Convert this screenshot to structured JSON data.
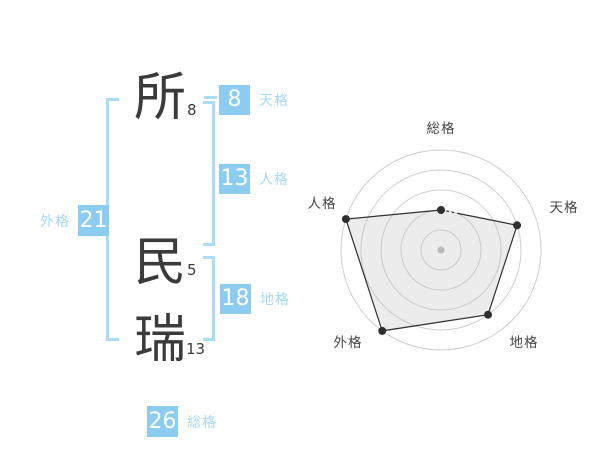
{
  "name_panel": {
    "characters": [
      {
        "char": "所",
        "strokes": "8"
      },
      {
        "char": "民",
        "strokes": "5"
      },
      {
        "char": "瑞",
        "strokes": "13"
      }
    ],
    "badges": {
      "tenkaku": {
        "value": "8",
        "label": "天格"
      },
      "jinkaku": {
        "value": "13",
        "label": "人格"
      },
      "chikaku": {
        "value": "18",
        "label": "地格"
      },
      "gaikaku": {
        "value": "21",
        "label": "外格"
      },
      "soukaku": {
        "value": "26",
        "label": "総格"
      }
    }
  },
  "colors": {
    "badge_blue": "#8cccf0",
    "light_blue_label": "#a5d9f6",
    "bracket_blue": "#a9dcf7",
    "ink": "#3b3b3b",
    "ring_gray": "#cfcfcf",
    "polygon_stroke": "#2f2f2f",
    "polygon_fill": "rgba(185,185,185,0.28)",
    "center_dot": "#b9b9b9",
    "axis_label": "#474747"
  },
  "chart_data": {
    "type": "radar",
    "title": "",
    "axes": [
      "総格",
      "天格",
      "地格",
      "外格",
      "人格"
    ],
    "values": [
      2,
      4,
      4,
      5,
      5
    ],
    "max": 5,
    "rings": 5,
    "grid": "circular",
    "legend": "none",
    "note": "luck score per category read off concentric rings 1-5"
  }
}
